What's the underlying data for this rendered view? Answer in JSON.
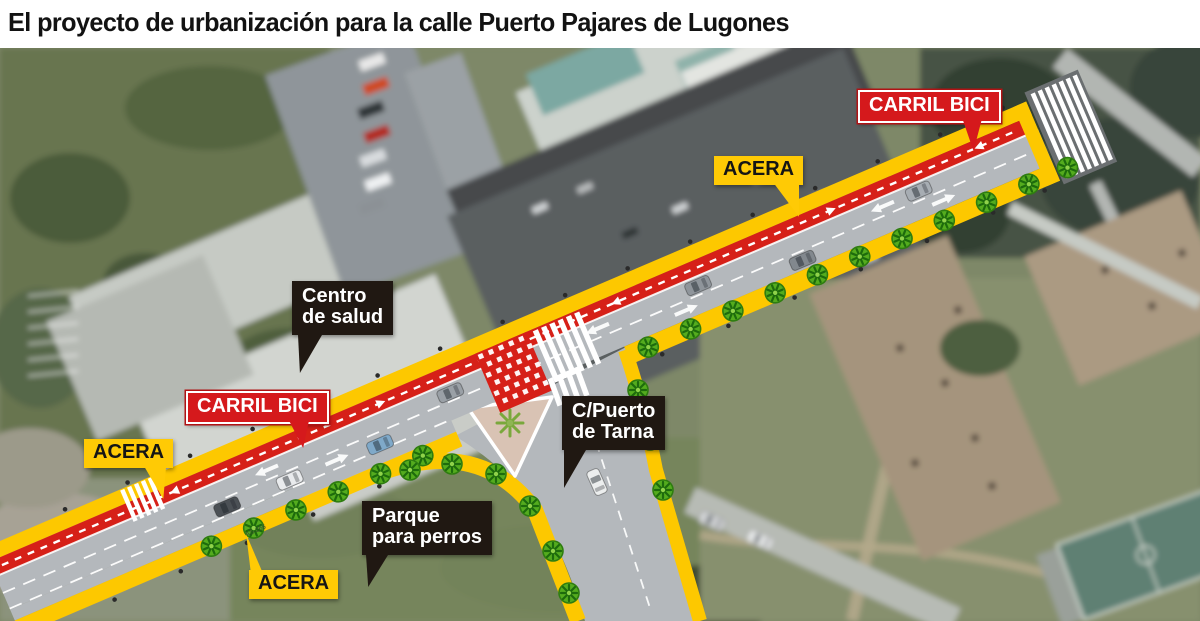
{
  "header": {
    "title": "El proyecto de urbanización para la calle Puerto Pajares de Lugones"
  },
  "map": {
    "road_code": "AS-266",
    "labels": {
      "carril_bici_top": {
        "text": "CARRIL BICI"
      },
      "acera_top": {
        "text": "ACERA"
      },
      "centro_salud": {
        "line1": "Centro",
        "line2": "de salud"
      },
      "carril_bici_left": {
        "text": "CARRIL BICI"
      },
      "acera_left": {
        "text": "ACERA"
      },
      "puerto_tarna": {
        "line1": "C/Puerto",
        "line2": "de Tarna"
      },
      "parque_perros": {
        "line1": "Parque",
        "line2": "para perros"
      },
      "acera_bottom": {
        "text": "ACERA"
      }
    },
    "colors": {
      "bike_lane": "#d62018",
      "sidewalk": "#fdc800",
      "carriageway": "#b4b8bc",
      "label_red": "#d5191c",
      "label_yellow": "#ffca05",
      "label_black": "#201812",
      "tree_green": "#54ac1e"
    }
  }
}
